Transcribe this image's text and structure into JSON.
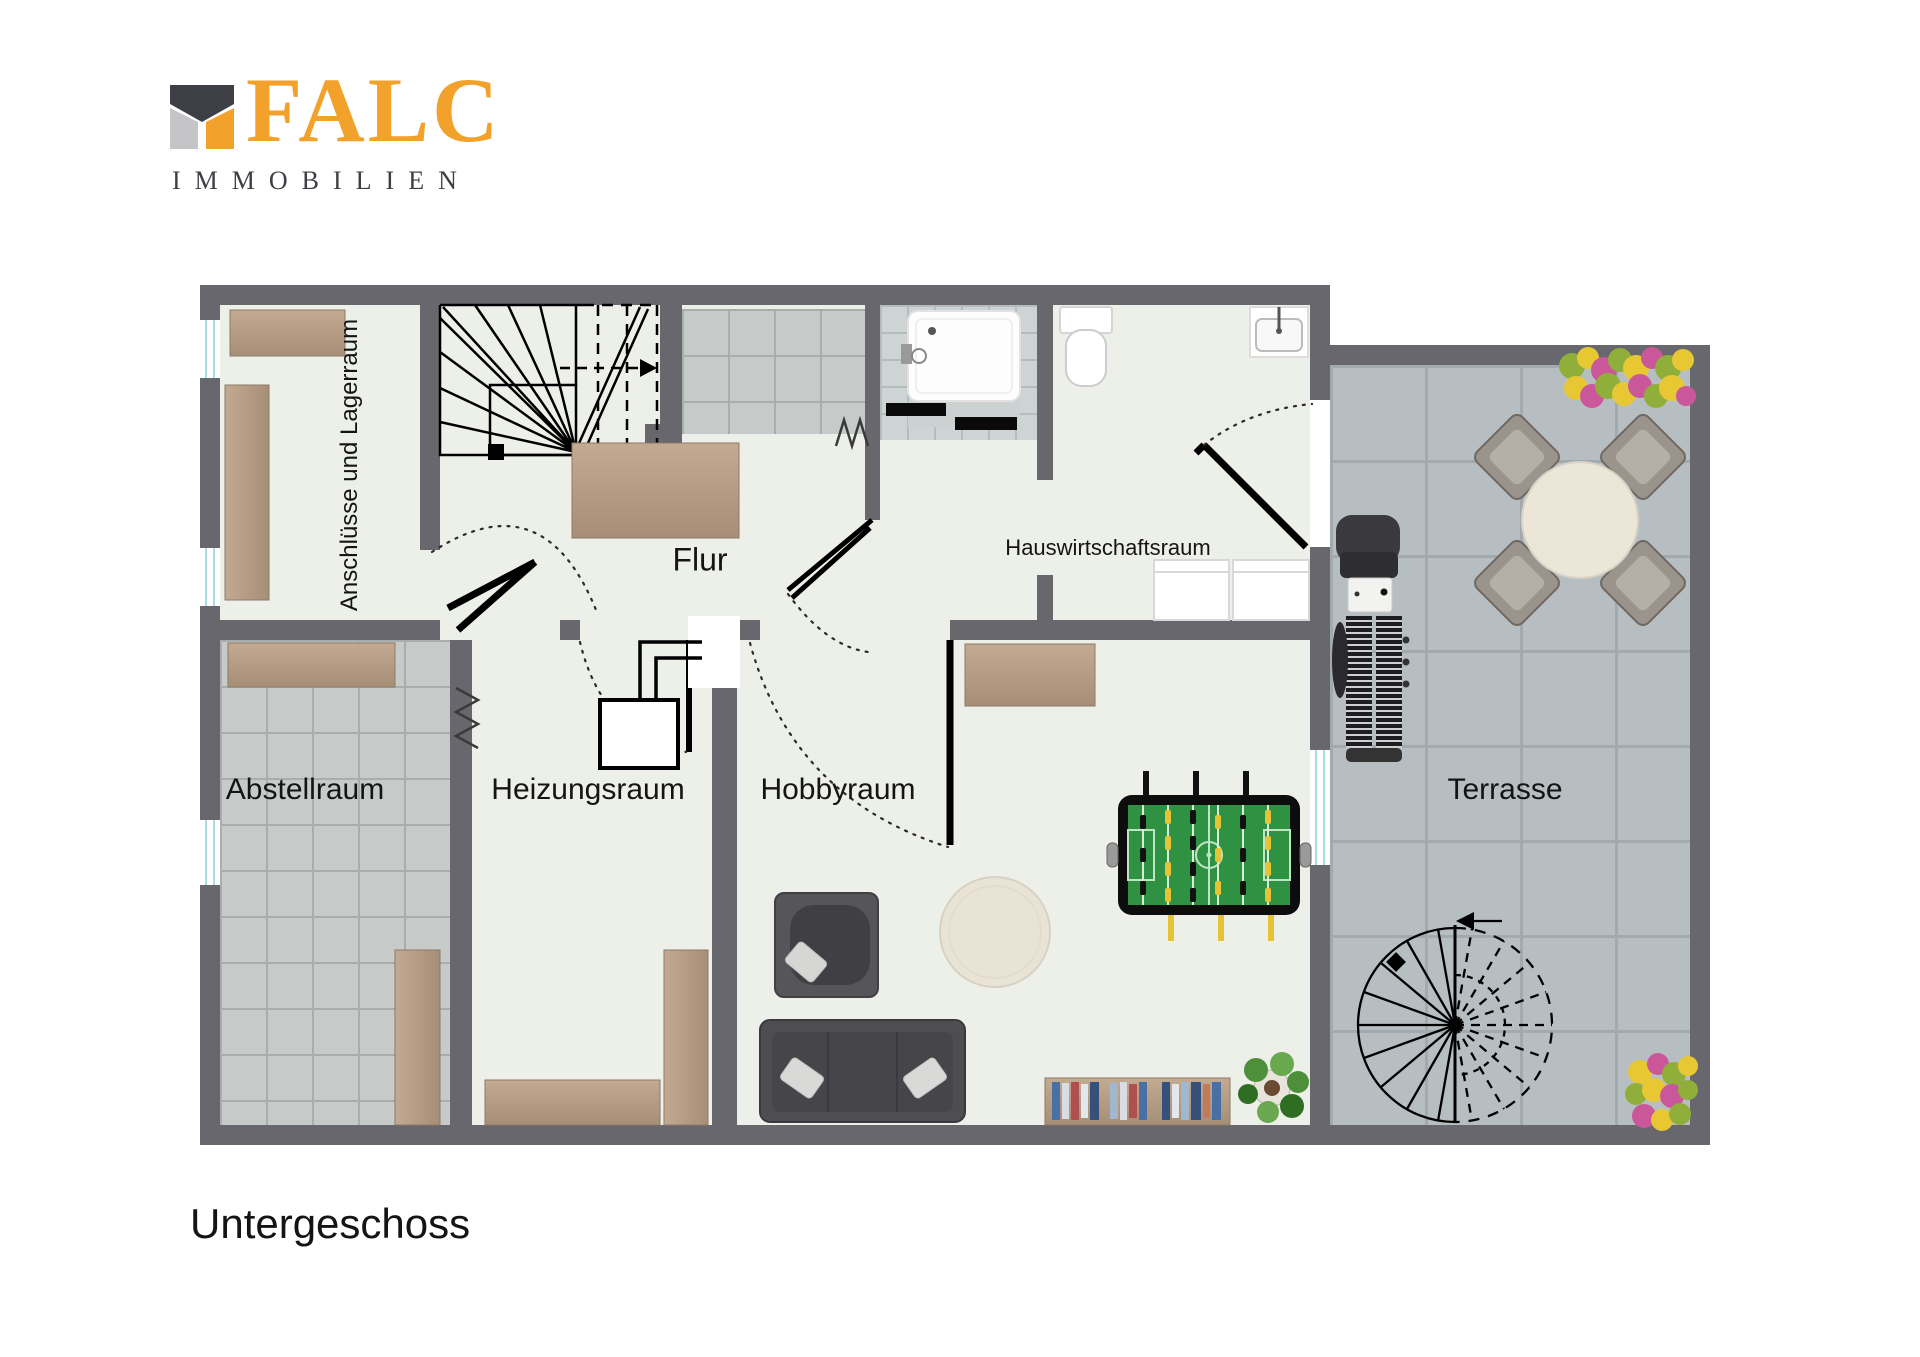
{
  "logo": {
    "brand": "FALC",
    "subtitle": "IMMOBILIEN"
  },
  "plan": {
    "caption": "Untergeschoss"
  },
  "rooms": {
    "anschluesse": "Anschlüsse und Lagerraum",
    "flur": "Flur",
    "hauswirtschaftsraum": "Hauswirtschaftsraum",
    "abstellraum": "Abstellraum",
    "heizungsraum": "Heizungsraum",
    "hobbyraum": "Hobbyraum",
    "terrasse": "Terrasse"
  },
  "furniture_icons": [
    "winder-staircase-icon",
    "spiral-staircase-icon",
    "door-swing-icon",
    "double-door-icon",
    "shower-tray-icon",
    "toilet-icon",
    "sink-icon",
    "washer-icon",
    "boiler-icon",
    "radiator-icon",
    "shelf-icon",
    "sideboard-icon",
    "sofa-icon",
    "armchair-icon",
    "coffee-table-icon",
    "foosball-table-icon",
    "bookshelf-icon",
    "plant-icon",
    "grill-icon",
    "dining-set-icon",
    "flower-bed-icon",
    "window-icon"
  ],
  "colors": {
    "wall": "#67676d",
    "floor": "#edefe9",
    "tileA_bg": "#c6cbca",
    "tileA_line": "#a8aeae",
    "tileFine_bg": "#ced3d3",
    "tileFine_line": "#b4bcbc",
    "terr_bg": "#b7bec2",
    "terr_line": "#a2aaaf",
    "winline": "#aadde2",
    "ink": "#141414",
    "accent": "#f2a22b",
    "logo_dark": "#3e3e45",
    "logo_gray": "#c5c5c7",
    "wood_light": "#c3aa92",
    "wood_dark": "#a68e77",
    "sofa": "#4e4e52",
    "field_green": "#2f9242",
    "player_yellow": "#e6c235"
  }
}
